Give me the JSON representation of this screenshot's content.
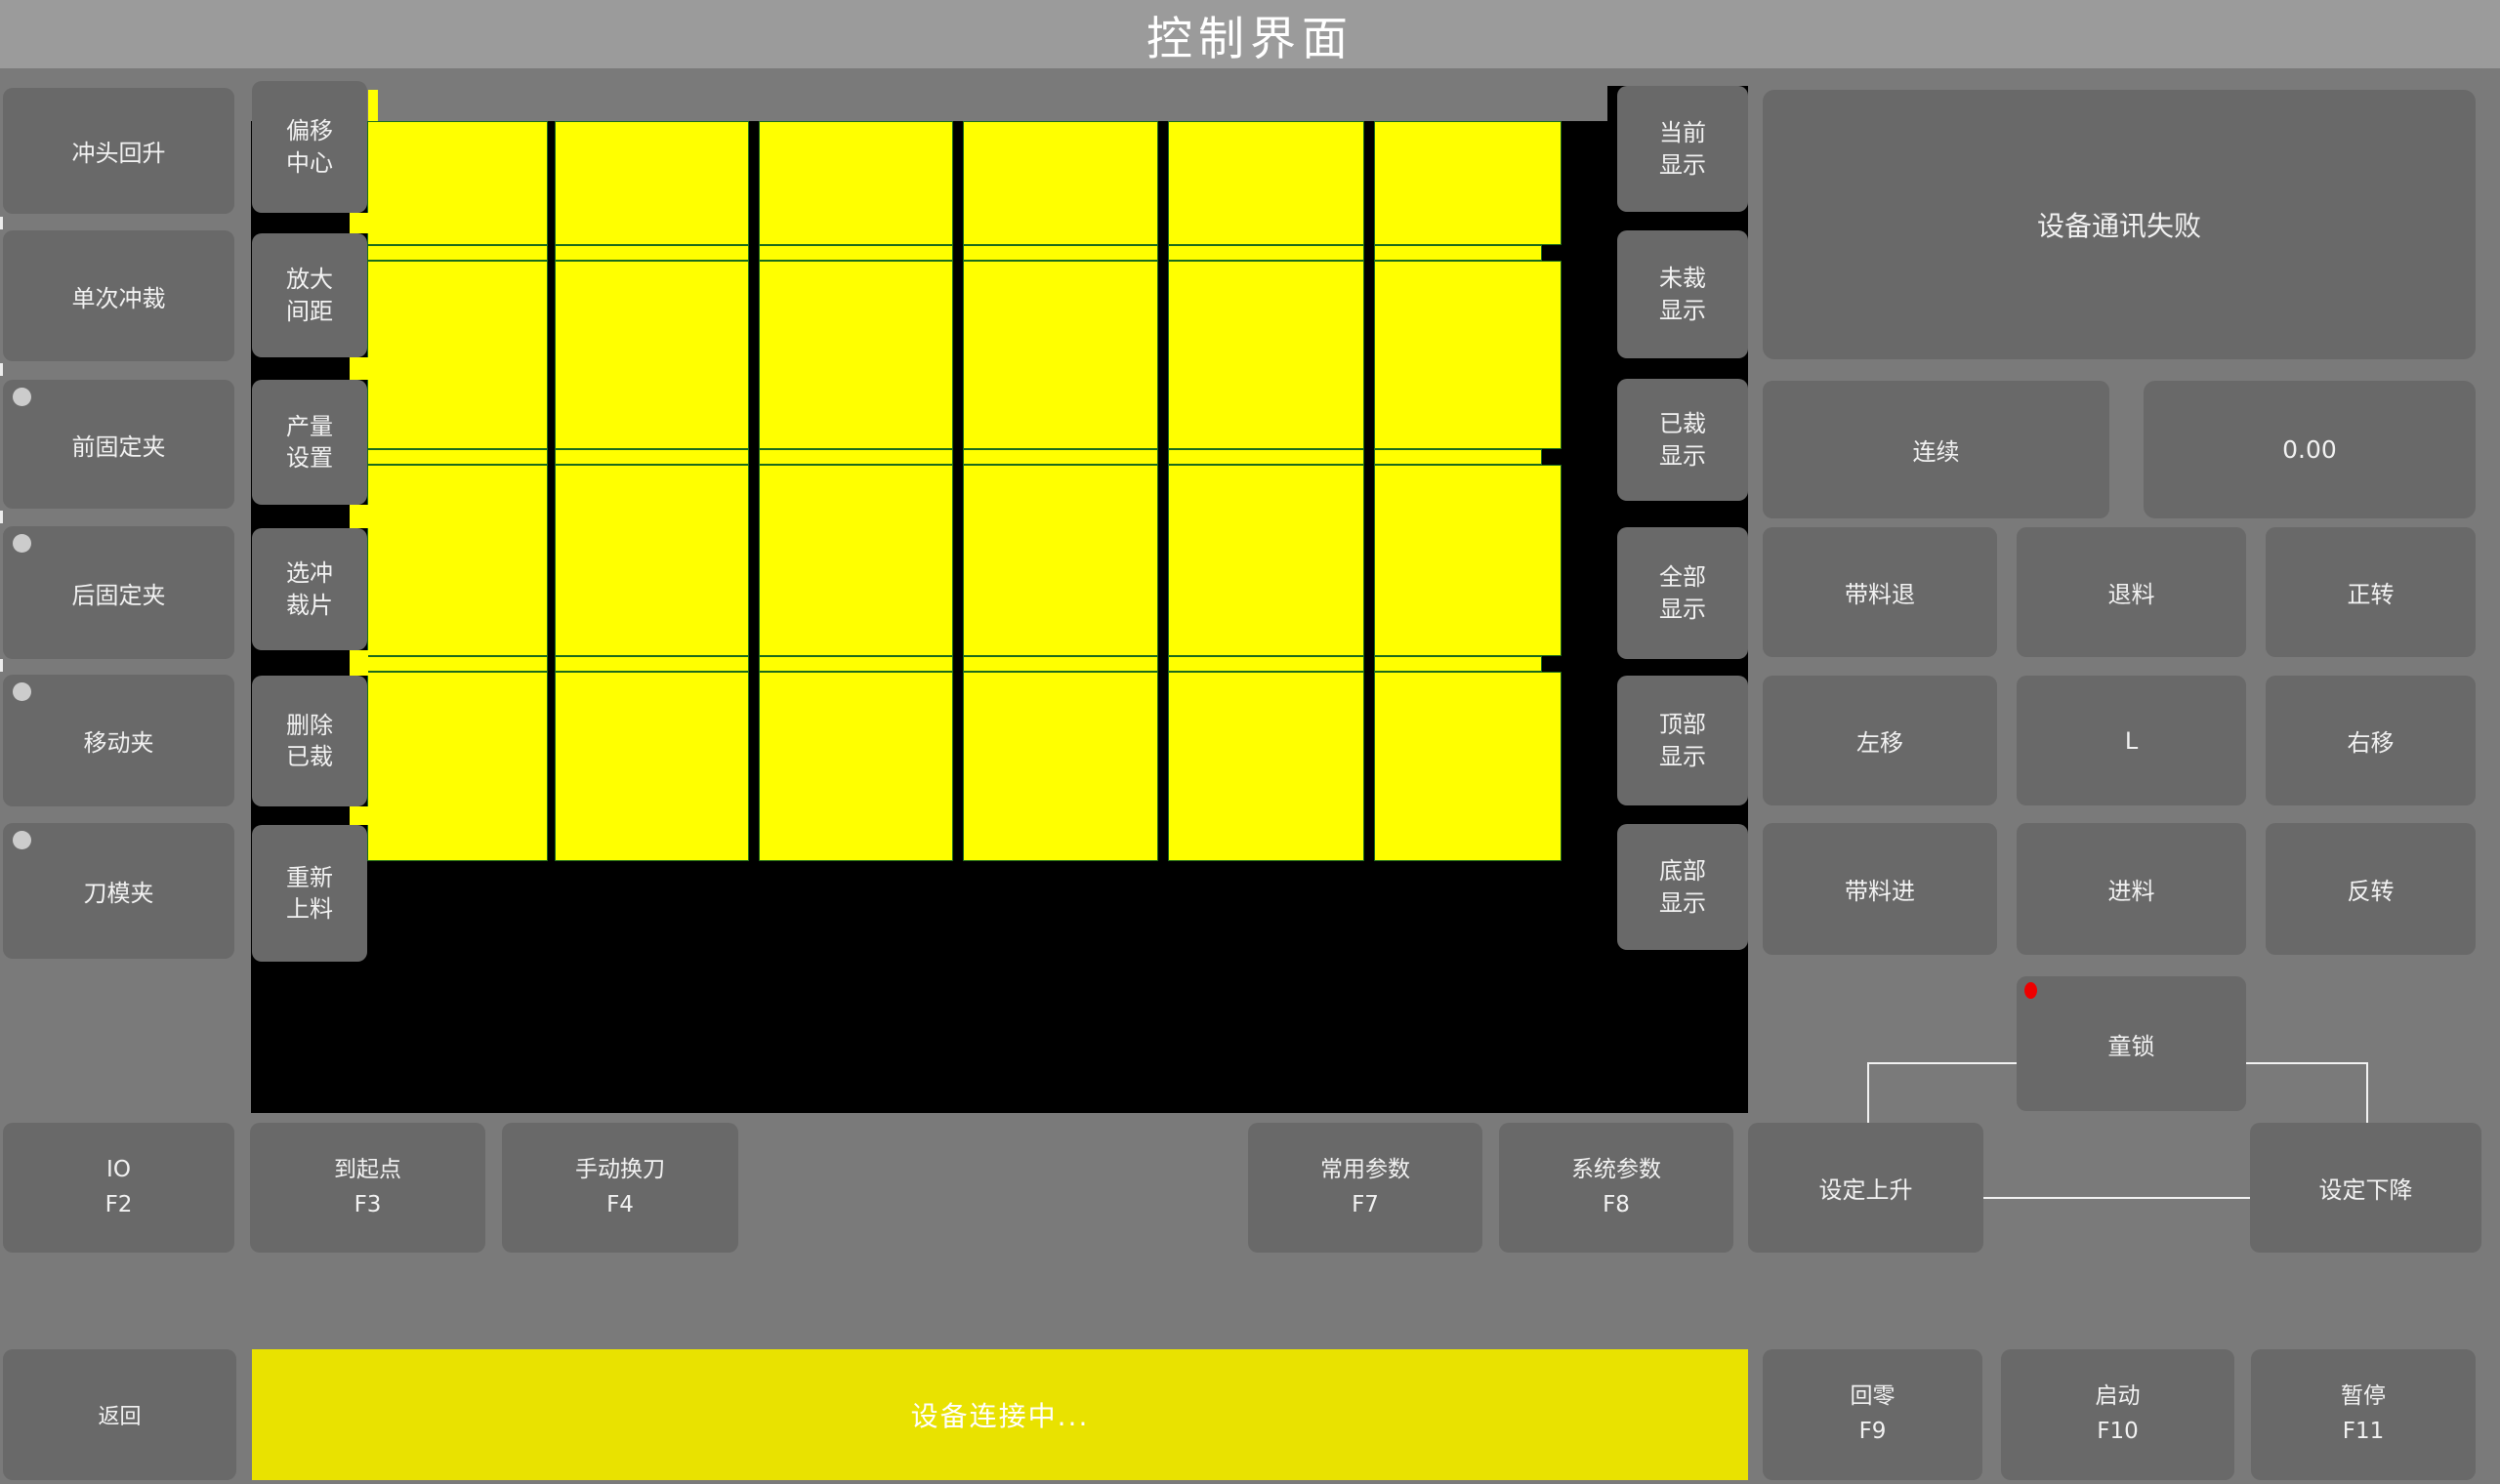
{
  "title": "控制界面",
  "colors": {
    "background": "#7a7a7a",
    "titlebar": "#9b9b9b",
    "button": "#696969",
    "canvas": "#000000",
    "piece_yellow": "#ffff00",
    "piece_border_green": "#1b6b1b",
    "statusbar_yellow": "#e9e200",
    "alarm_red": "#ee0000",
    "indicator_gray": "#cccccc",
    "text": "#f2f2f2"
  },
  "left_buttons": [
    {
      "label": "冲头回升"
    },
    {
      "label": "单次冲裁"
    },
    {
      "label": "前固定夹"
    },
    {
      "label": "后固定夹"
    },
    {
      "label": "移动夹"
    },
    {
      "label": "刀模夹"
    }
  ],
  "col2_buttons": [
    "偏移中心",
    "放大间距",
    "产量设置",
    "选冲裁片",
    "删除已裁",
    "重新上料"
  ],
  "display_buttons": [
    "当前显示",
    "未裁显示",
    "已裁显示",
    "全部显示",
    "顶部显示",
    "底部显示"
  ],
  "grid": {
    "type": "piece-layout",
    "cols": [
      [
        376,
        185
      ],
      [
        568,
        199
      ],
      [
        777,
        199
      ],
      [
        986,
        200
      ],
      [
        1196,
        201
      ],
      [
        1407,
        192
      ]
    ],
    "rows": [
      [
        124,
        127
      ],
      [
        267,
        193
      ],
      [
        476,
        196
      ],
      [
        688,
        194
      ]
    ],
    "strips": [
      251,
      460,
      672
    ],
    "strip_h": 16,
    "piece_color": "#ffff00",
    "border_color": "#1b6b1b"
  },
  "panel": {
    "status": "设备通讯失败",
    "mode": "连续",
    "value": "0.00",
    "jog": [
      [
        "带料退",
        "退料",
        "正转"
      ],
      [
        "左移",
        "L",
        "右移"
      ],
      [
        "带料进",
        "进料",
        "反转"
      ]
    ],
    "child_lock": "童锁"
  },
  "fkeys": [
    {
      "label": "IO",
      "key": "F2"
    },
    {
      "label": "到起点",
      "key": "F3"
    },
    {
      "label": "手动换刀",
      "key": "F4"
    },
    {
      "label": "常用参数",
      "key": "F7"
    },
    {
      "label": "系统参数",
      "key": "F8"
    }
  ],
  "set_up": "设定上升",
  "set_down": "设定下降",
  "bottom": {
    "back": "返回",
    "status": "设备连接中...",
    "fkeys": [
      {
        "label": "回零",
        "key": "F9"
      },
      {
        "label": "启动",
        "key": "F10"
      },
      {
        "label": "暂停",
        "key": "F11"
      }
    ]
  }
}
